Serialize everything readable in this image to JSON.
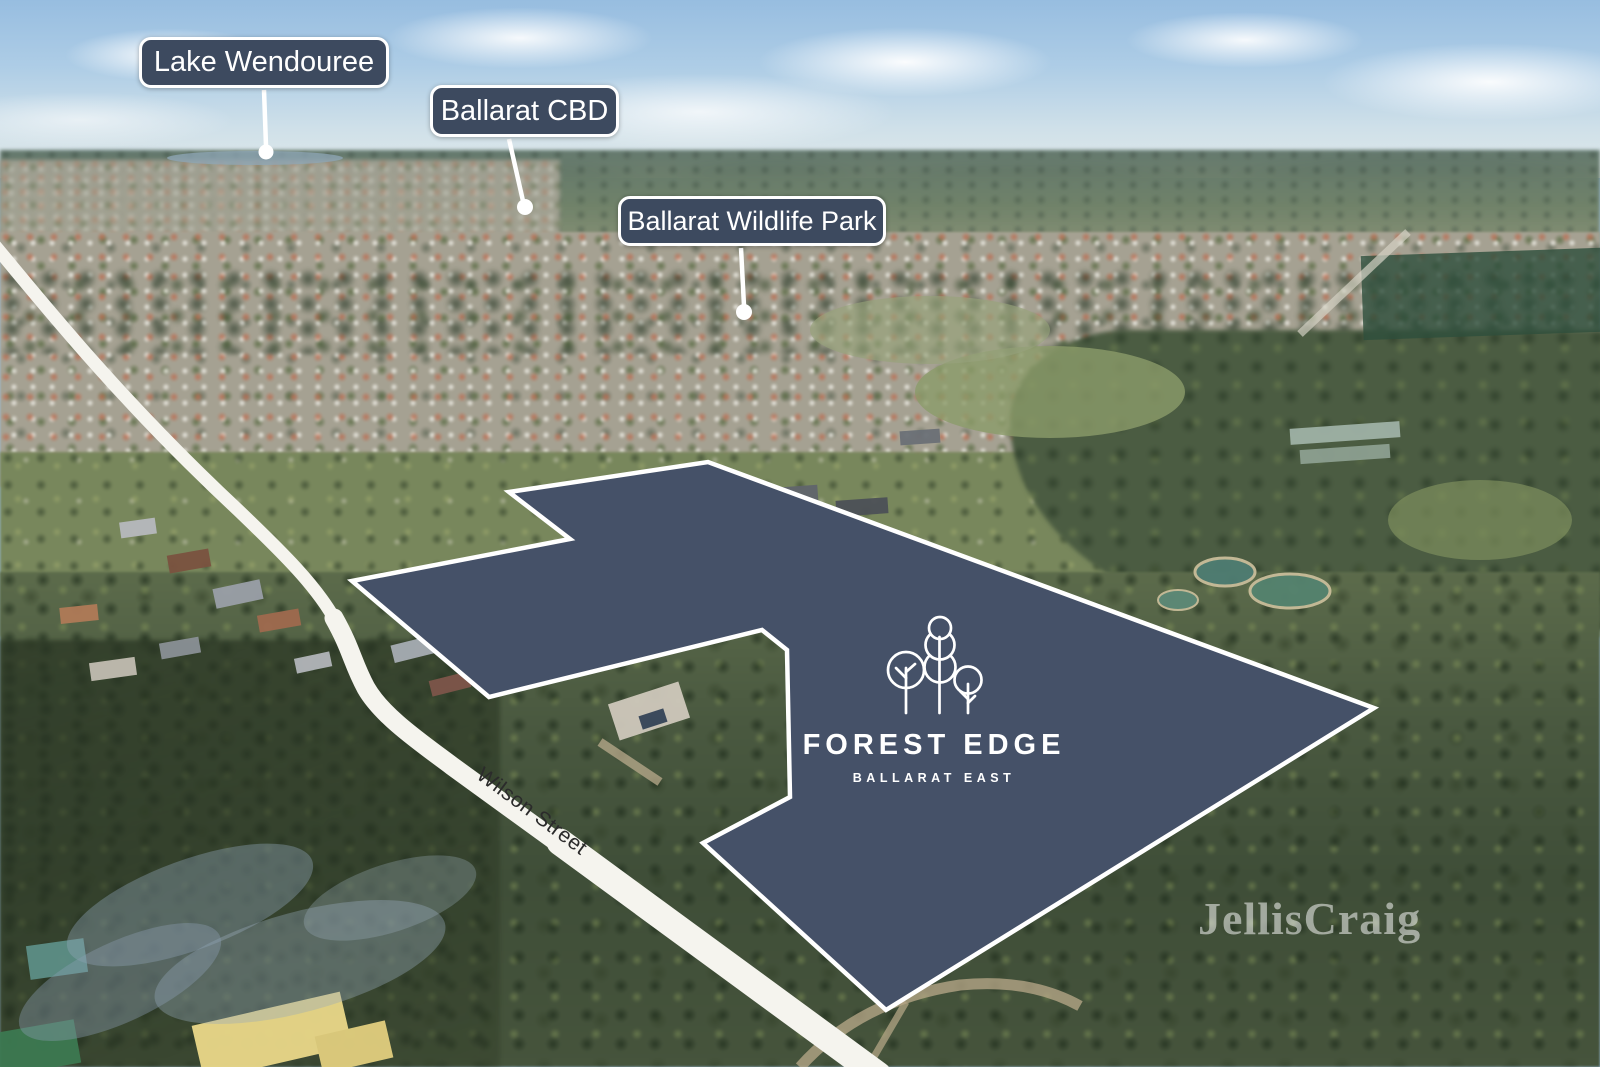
{
  "colors": {
    "label_bg": "#3d4a5f",
    "label_border": "#ffffff",
    "label_text": "#ffffff",
    "site_fill": "#455168",
    "site_stroke": "#ffffff",
    "road_fill": "#f5f4ee",
    "road_text": "#2b2b2b",
    "logo_text": "#ffffff",
    "watermark_text": "#ffffff"
  },
  "callouts": [
    {
      "id": "lake-wendouree",
      "text": "Lake Wendouree"
    },
    {
      "id": "ballarat-cbd",
      "text": "Ballarat CBD"
    },
    {
      "id": "ballarat-wildlife-park",
      "text": "Ballarat Wildlife Park"
    }
  ],
  "site": {
    "name": "FOREST EDGE",
    "location": "BALLARAT EAST"
  },
  "road": {
    "name": "Wilson Street"
  },
  "watermark": {
    "text": "JellisCraig"
  }
}
